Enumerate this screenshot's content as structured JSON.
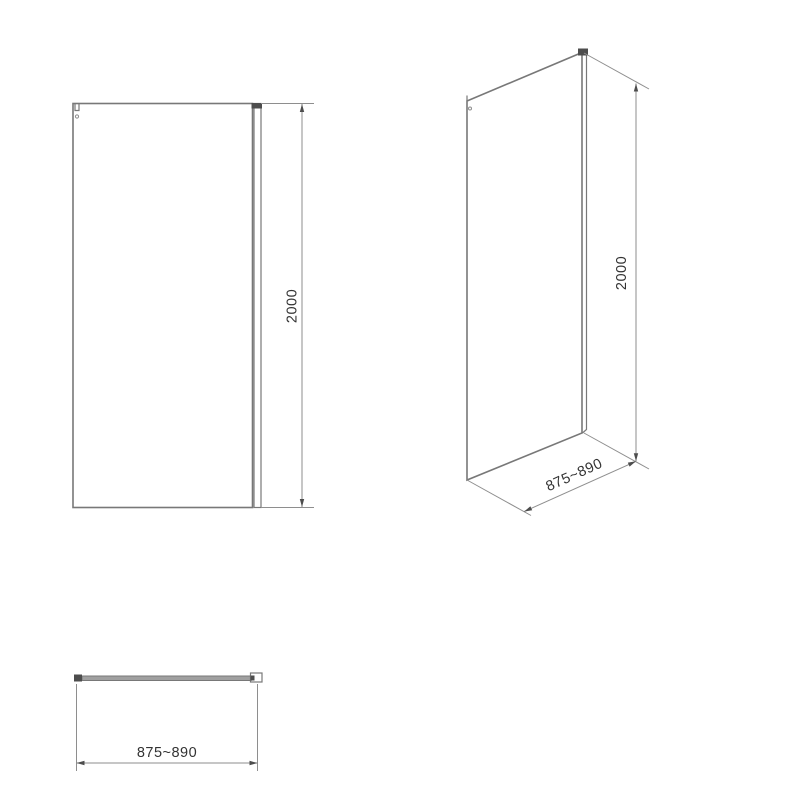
{
  "views": {
    "front": {
      "height_dim": "2000"
    },
    "perspective": {
      "height_dim": "2000",
      "width_dim": "875~890"
    },
    "plan": {
      "width_dim": "875~890"
    }
  },
  "colors": {
    "line": "#787878",
    "thin": "#8e8e8e",
    "dark": "#4d4d4d",
    "text": "#333333",
    "background": "#ffffff"
  }
}
